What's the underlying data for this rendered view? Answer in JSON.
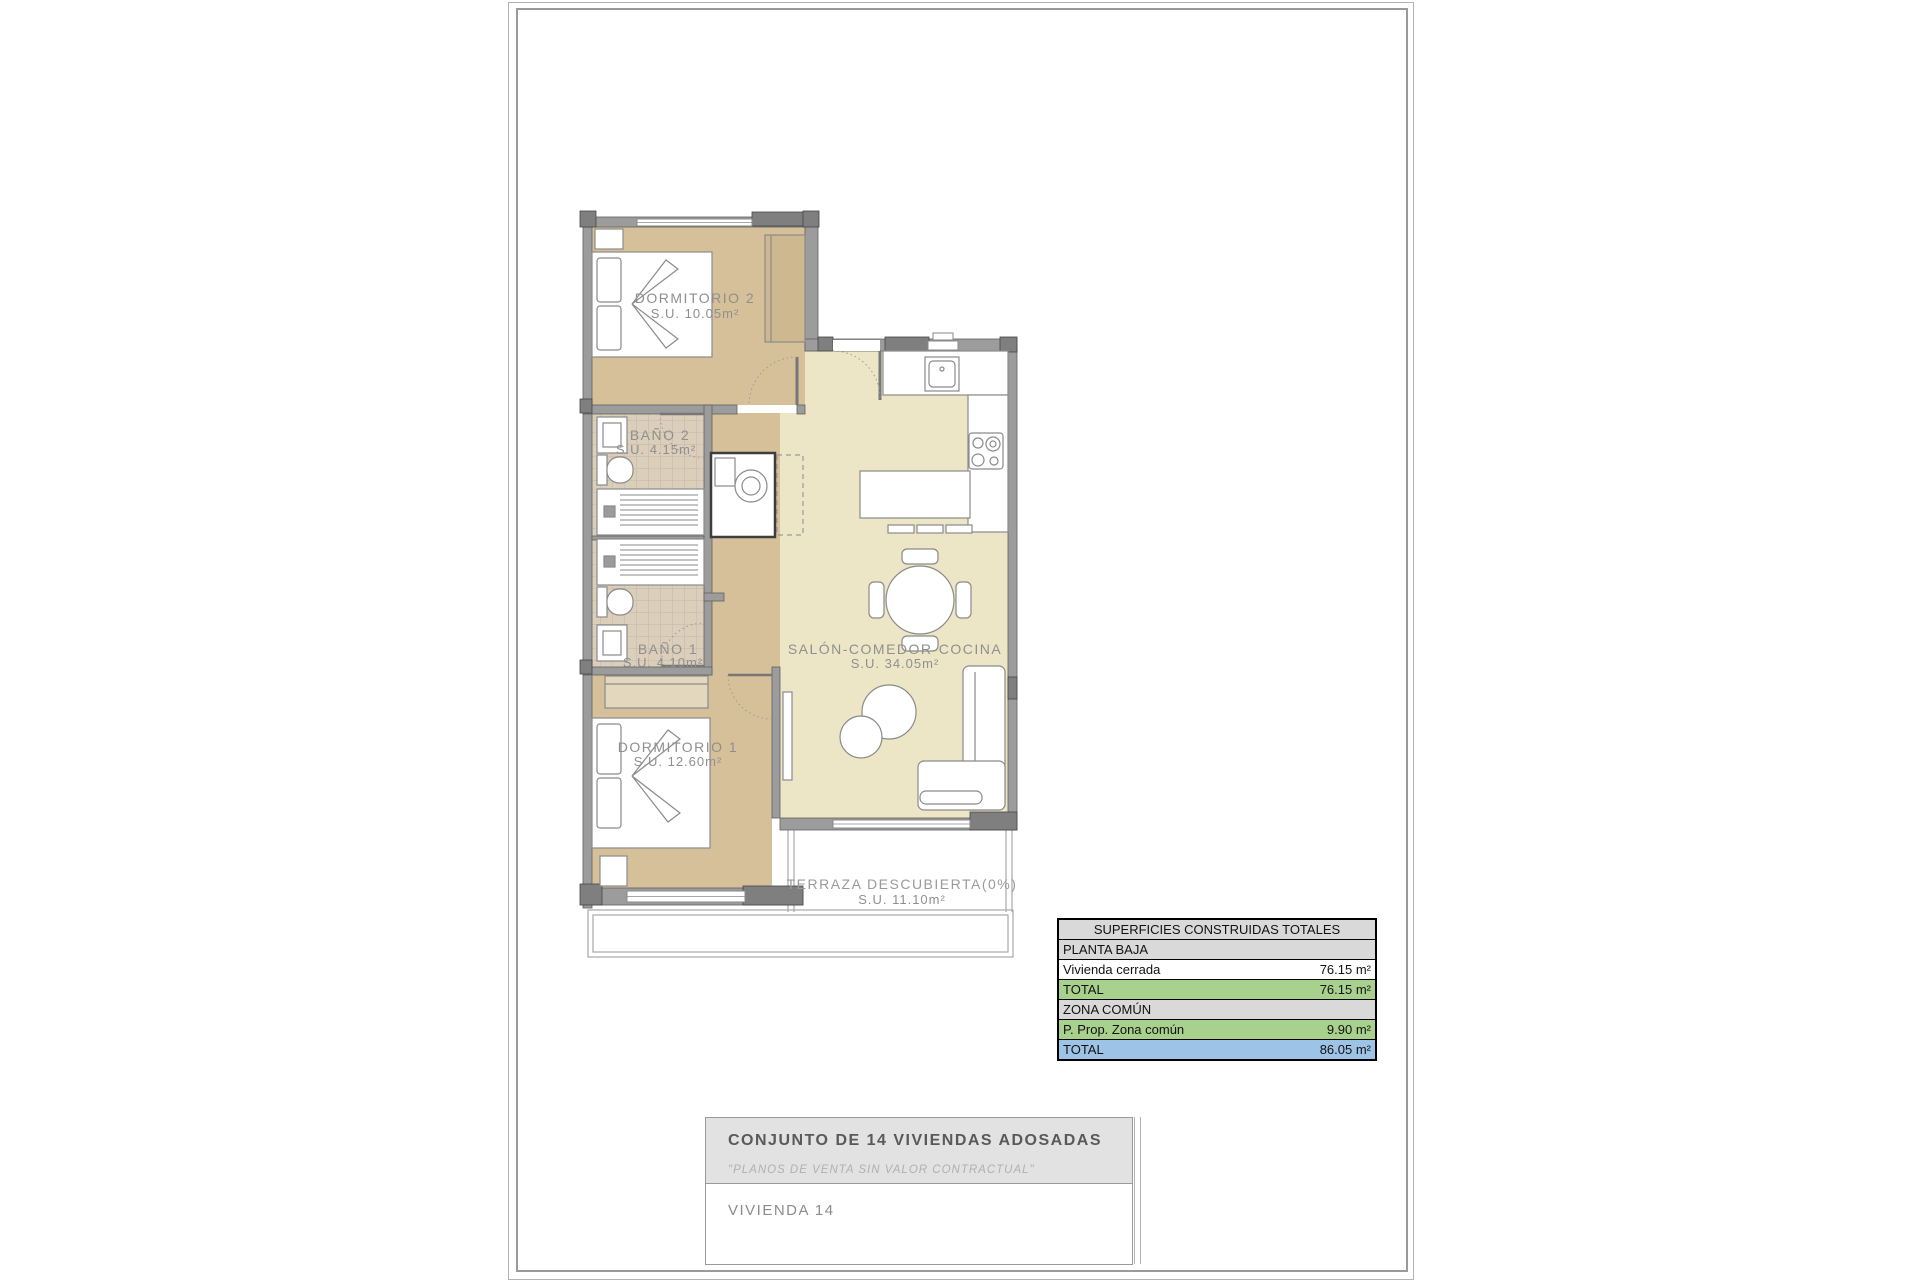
{
  "plan": {
    "rooms": [
      {
        "id": "dormitorio2",
        "label": "DORMITORIO 2",
        "area": "S.U. 10.05m²"
      },
      {
        "id": "bano2",
        "label": "BAÑO 2",
        "area": "S.U. 4.15m²"
      },
      {
        "id": "bano1",
        "label": "BAÑO 1",
        "area": "S.U. 4.10m²"
      },
      {
        "id": "dormitorio1",
        "label": "DORMITORIO 1",
        "area": "S.U. 12.60m²"
      },
      {
        "id": "salon",
        "label": "SALÓN-COMEDOR-COCINA",
        "area": "S.U. 34.05m²"
      },
      {
        "id": "terraza",
        "label": "TERRAZA DESCUBIERTA(0%)",
        "area": "S.U. 11.10m²"
      }
    ],
    "colors": {
      "bedroom_floor": "#d6c09a",
      "living_floor": "#ede6c6",
      "bathroom_tile": "#dbcfbc",
      "wall": "#9c9c9c",
      "wall_corner": "#7f7f7f"
    }
  },
  "areas_table": {
    "title": "SUPERFICIES CONSTRUIDAS TOTALES",
    "rows": [
      {
        "label": "PLANTA BAJA",
        "value": ""
      },
      {
        "label": "Vivienda cerrada",
        "value": "76.15 m²"
      },
      {
        "label": "TOTAL",
        "value": "76.15 m²"
      },
      {
        "label": "ZONA COMÚN",
        "value": ""
      },
      {
        "label": "P. Prop. Zona común",
        "value": "9.90 m²"
      },
      {
        "label": "TOTAL",
        "value": "86.05 m²"
      }
    ],
    "colors": {
      "section": "#d9d9d9",
      "subtotal": "#a9d18e",
      "total": "#9dc3e6"
    }
  },
  "title_block": {
    "project": "CONJUNTO DE 14 VIVIENDAS ADOSADAS",
    "disclaimer": "\"PLANOS DE VENTA SIN VALOR CONTRACTUAL\"",
    "unit": "VIVIENDA 14"
  }
}
